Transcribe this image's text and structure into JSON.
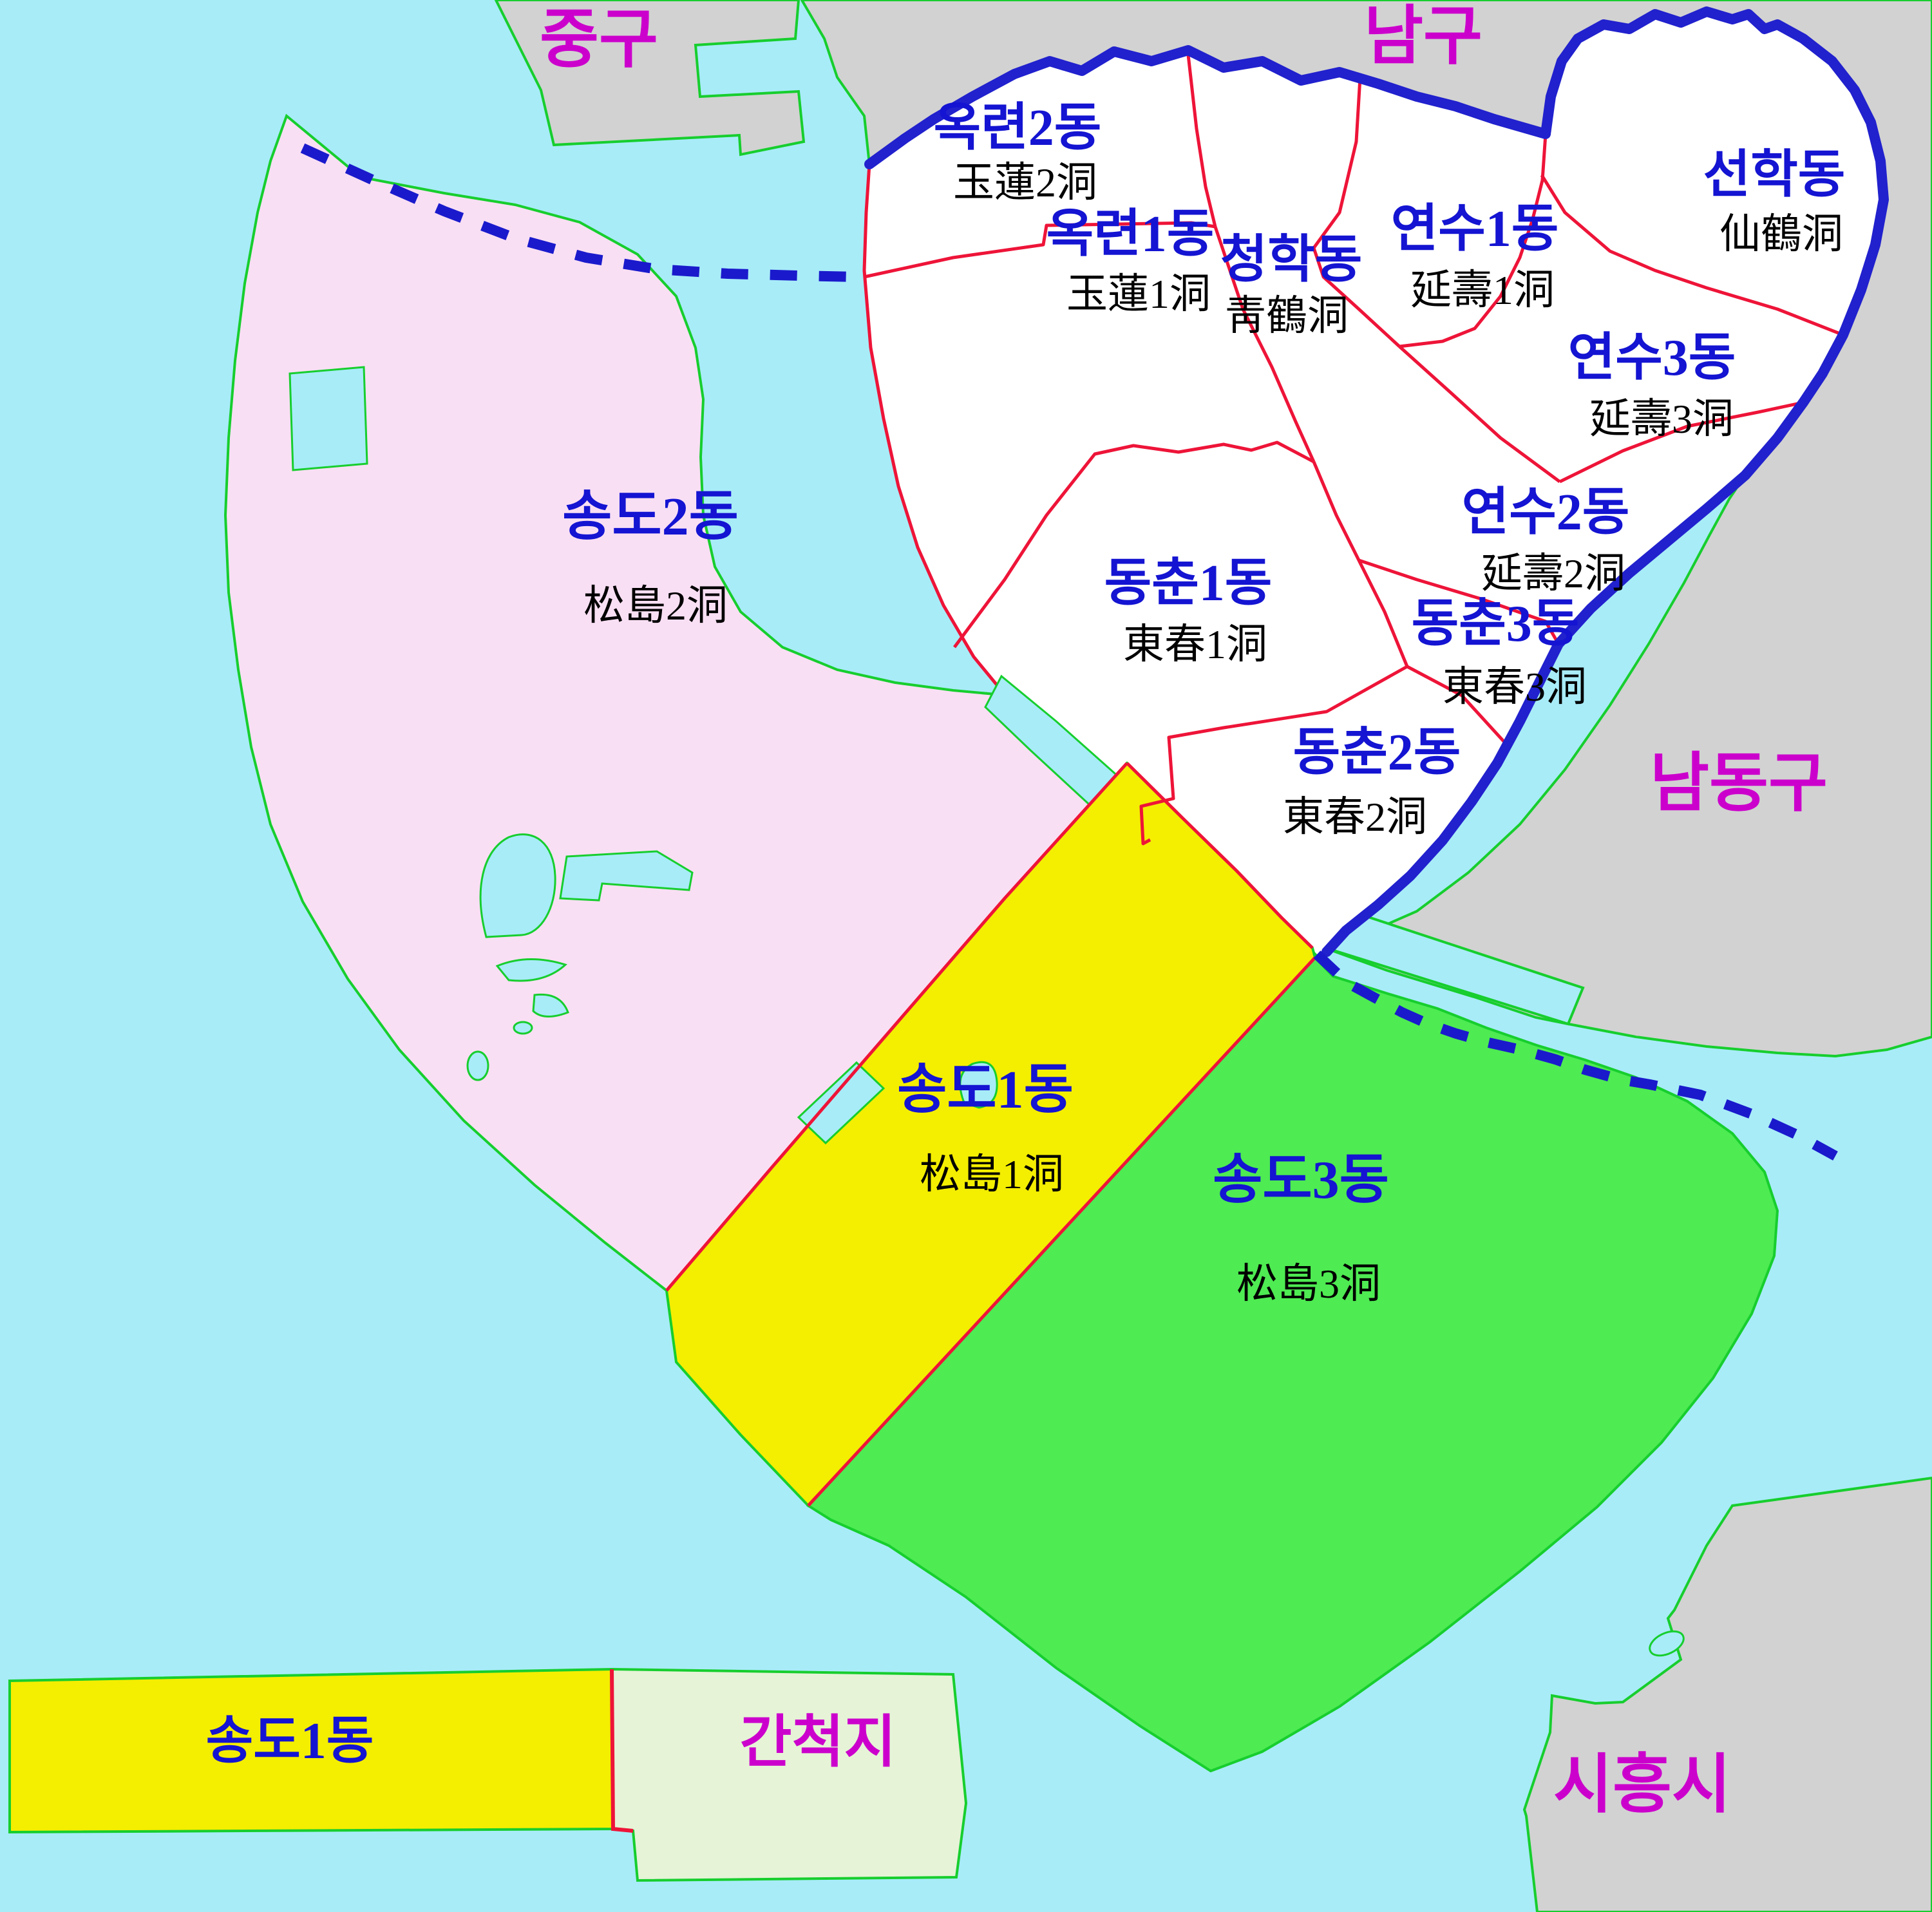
{
  "map": {
    "type": "administrative-district-map",
    "subject": "Yeonsu-gu, Incheon dong subdivisions"
  },
  "colors": {
    "water": "#A8ECF8",
    "neighbor_land": "#D2D2D2",
    "district_white": "#FFFFFF",
    "songdo2_pink": "#F9DFF4",
    "songdo1_yellow": "#F4EE00",
    "songdo3_green": "#4EEB52",
    "reclaimed_lightgreen": "#E6F3D7",
    "coast_outline_green": "#17CE2E",
    "dong_boundary_red": "#EE1438",
    "district_border_blue": "#2121CE",
    "maritime_dashed_blue": "#1A1ACC",
    "dong_label_blue": "#1414D2",
    "hanja_label_black": "#000000",
    "neighbor_label_magenta": "#CC00CC"
  },
  "neighbors": {
    "jung_gu": {
      "ko": "중구"
    },
    "nam_gu": {
      "ko": "남구"
    },
    "namdong_gu": {
      "ko": "남동구"
    },
    "siheung_si": {
      "ko": "시흥시"
    },
    "reclaimed": {
      "ko": "간척지"
    }
  },
  "dongs": {
    "okryeon2": {
      "ko": "옥련2동",
      "hanja": "玉蓮2洞"
    },
    "okryeon1": {
      "ko": "옥련1동",
      "hanja": "玉蓮1洞"
    },
    "cheonghak": {
      "ko": "청학동",
      "hanja": "靑鶴洞"
    },
    "yeonsu1": {
      "ko": "연수1동",
      "hanja": "延壽1洞"
    },
    "seonhak": {
      "ko": "선학동",
      "hanja": "仙鶴洞"
    },
    "yeonsu3": {
      "ko": "연수3동",
      "hanja": "延壽3洞"
    },
    "yeonsu2": {
      "ko": "연수2동",
      "hanja": "延壽2洞"
    },
    "dongchun1": {
      "ko": "동춘1동",
      "hanja": "東春1洞"
    },
    "dongchun3": {
      "ko": "동춘3동",
      "hanja": "東春3洞"
    },
    "dongchun2": {
      "ko": "동춘2동",
      "hanja": "東春2洞"
    },
    "songdo2": {
      "ko": "송도2동",
      "hanja": "松島2洞"
    },
    "songdo1": {
      "ko": "송도1동",
      "hanja": "松島1洞"
    },
    "songdo3": {
      "ko": "송도3동",
      "hanja": "松島3洞"
    },
    "songdo1_south": {
      "ko": "송도1동"
    }
  }
}
